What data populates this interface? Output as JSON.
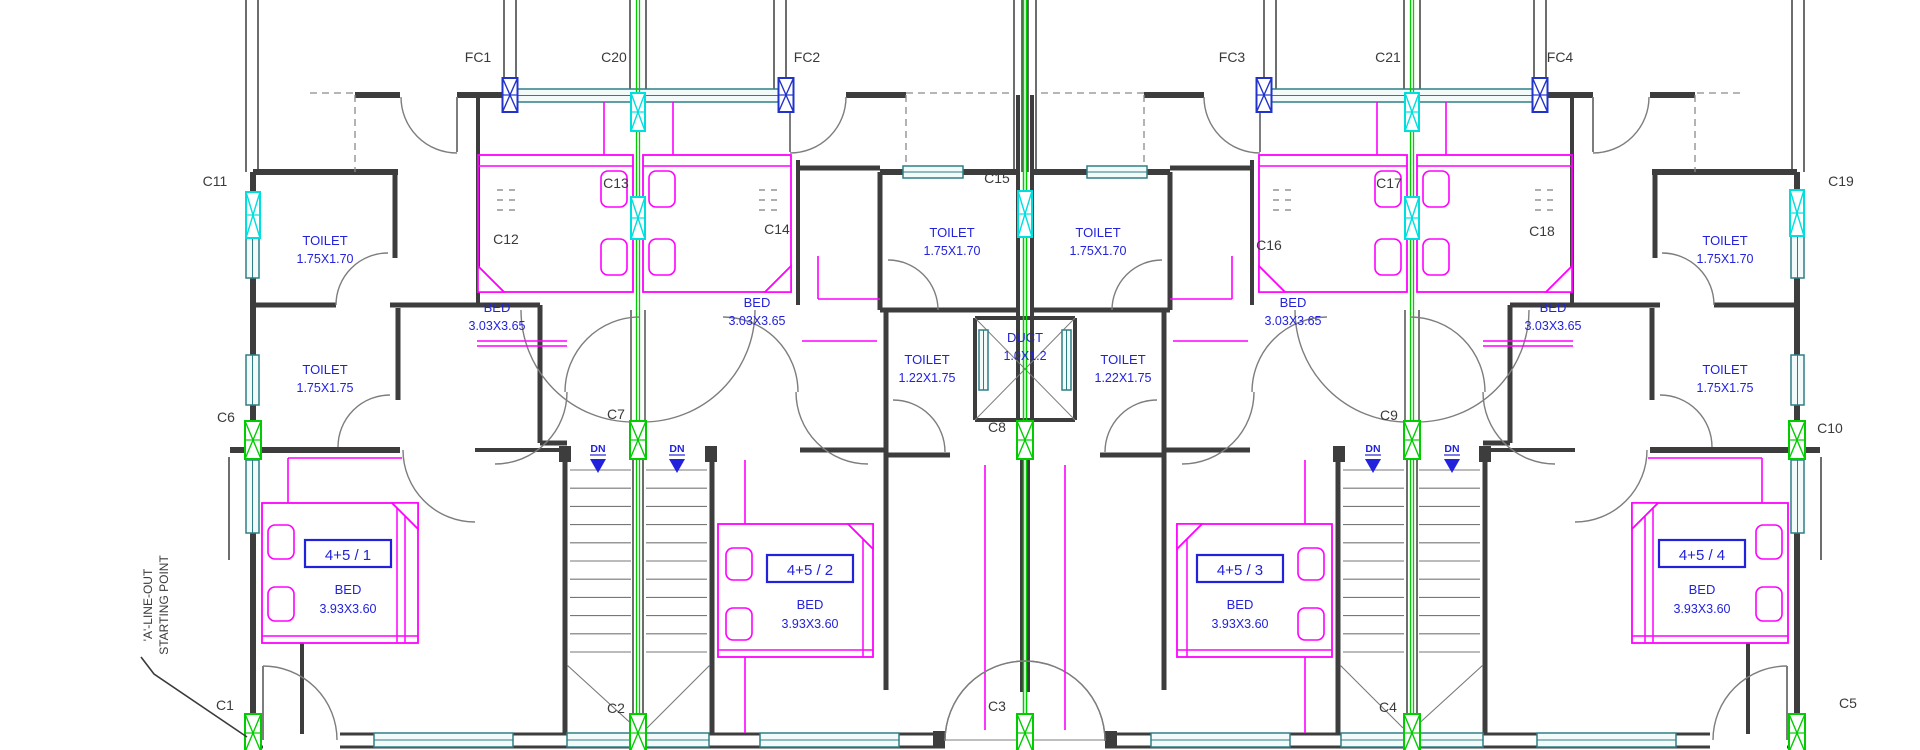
{
  "drawing": {
    "type": "architectural-floor-plan",
    "annotation": {
      "line1": "'A'-LINE-OUT",
      "line2": "STARTING POINT"
    },
    "stair_label": "DN",
    "columns": {
      "C1": "C1",
      "C2": "C2",
      "C3": "C3",
      "C4": "C4",
      "C5": "C5",
      "C6": "C6",
      "C7": "C7",
      "C8": "C8",
      "C9": "C9",
      "C10": "C10",
      "C11": "C11",
      "C12": "C12",
      "C13": "C13",
      "C14": "C14",
      "C15": "C15",
      "C16": "C16",
      "C17": "C17",
      "C18": "C18",
      "C19": "C19",
      "C20": "C20",
      "C21": "C21",
      "FC1": "FC1",
      "FC2": "FC2",
      "FC3": "FC3",
      "FC4": "FC4"
    },
    "rooms": {
      "toilet_left_upper": {
        "name": "TOILET",
        "dims": "1.75X1.70"
      },
      "toilet_left_lower": {
        "name": "TOILET",
        "dims": "1.75X1.75"
      },
      "toilet_center_left_upper": {
        "name": "TOILET",
        "dims": "1.75X1.70"
      },
      "toilet_center_right_upper": {
        "name": "TOILET",
        "dims": "1.75X1.70"
      },
      "toilet_center_left_lower": {
        "name": "TOILET",
        "dims": "1.22X1.75"
      },
      "toilet_center_right_lower": {
        "name": "TOILET",
        "dims": "1.22X1.75"
      },
      "toilet_right_upper": {
        "name": "TOILET",
        "dims": "1.75X1.70"
      },
      "toilet_right_lower": {
        "name": "TOILET",
        "dims": "1.75X1.75"
      },
      "duct": {
        "name": "DUCT",
        "dims": "1.0X1.2"
      },
      "bed_upper_1": {
        "name": "BED",
        "dims": "3.03X3.65"
      },
      "bed_upper_2": {
        "name": "BED",
        "dims": "3.03X3.65"
      },
      "bed_upper_3": {
        "name": "BED",
        "dims": "3.03X3.65"
      },
      "bed_upper_4": {
        "name": "BED",
        "dims": "3.03X3.65"
      }
    },
    "units": [
      {
        "label": "4+5 / 1",
        "room": "BED",
        "dims": "3.93X3.60"
      },
      {
        "label": "4+5 / 2",
        "room": "BED",
        "dims": "3.93X3.60"
      },
      {
        "label": "4+5 / 3",
        "room": "BED",
        "dims": "3.93X3.60"
      },
      {
        "label": "4+5 / 4",
        "room": "BED",
        "dims": "3.93X3.60"
      }
    ],
    "colors": {
      "wall": "#3d3d3d",
      "wall_light": "#8a8a8a",
      "door": "#7d7d7d",
      "grid_green": "#00cc00",
      "marker_cyan": "#00dede",
      "marker_blue": "#2233cc",
      "window_teal": "#2e7f85",
      "window_fill": "#f2fafa",
      "furniture_magenta": "#ff00ff",
      "text_blue": "#2222dd",
      "text_dark": "#3a3a3a"
    }
  }
}
